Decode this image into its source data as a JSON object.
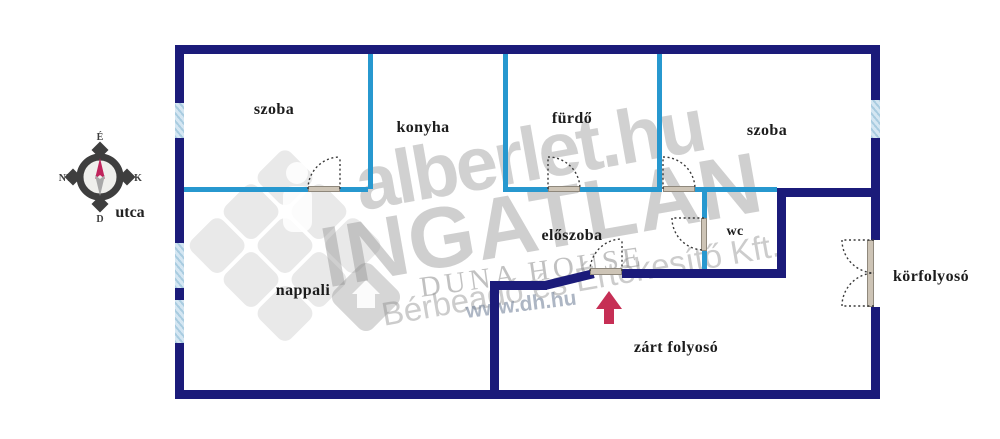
{
  "title": "apartment floor plan",
  "rooms": [
    {
      "name": "szoba-left",
      "label": "szoba"
    },
    {
      "name": "konyha",
      "label": "konyha"
    },
    {
      "name": "furdo",
      "label": "fürdő"
    },
    {
      "name": "szoba-right",
      "label": "szoba"
    },
    {
      "name": "eloszoba",
      "label": "előszoba"
    },
    {
      "name": "wc",
      "label": "wc"
    },
    {
      "name": "nappali",
      "label": "nappali"
    },
    {
      "name": "korfolyoso",
      "label": "körfolyosó"
    },
    {
      "name": "zart-folyoso",
      "label": "zárt folyosó"
    }
  ],
  "street_label": "utca",
  "compass": {
    "north": "É",
    "east": "K",
    "south": "D",
    "west": "NY"
  },
  "watermarks": {
    "site": "alberlet.hu",
    "site2": "INGATLAN",
    "agency": "DUNA HOUSE",
    "agency_line": "Bérbeadó és Értékesítő Kft.",
    "agency_url": "www.dh.hu"
  },
  "colors": {
    "outer_wall": "#1b1b7a",
    "inner_wall": "#2798cf",
    "window_fill": "#d4e6f2",
    "window_stripe": "#a9cce0",
    "door_sill": "#cdc4b6",
    "entrance_arrow": "#c62f55",
    "compass_needle": "#c0245c",
    "label_text": "#1c1c1c",
    "watermark_gray": "#8f8f8f"
  }
}
